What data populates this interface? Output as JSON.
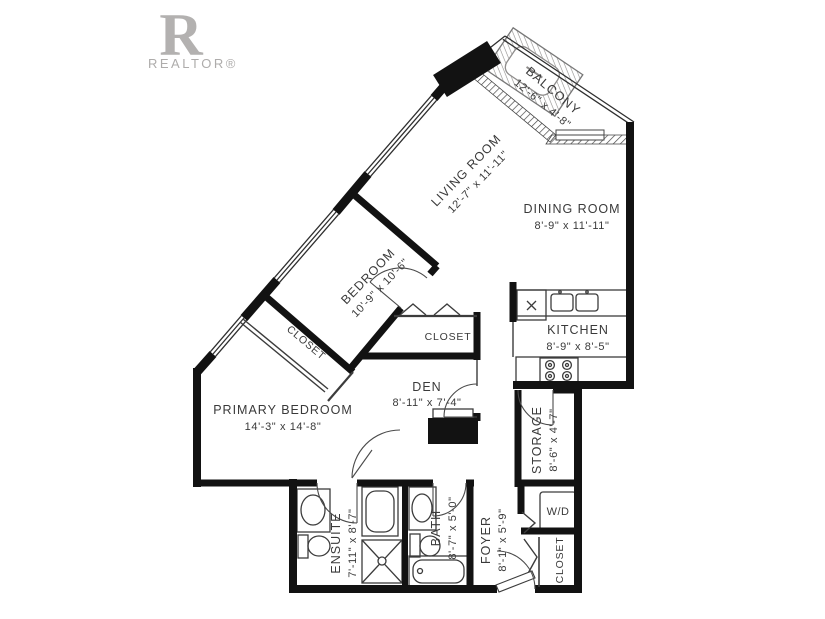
{
  "logo": {
    "monogram": "R",
    "wordmark": "REALTOR®"
  },
  "rooms": [
    {
      "id": "balcony",
      "name": "BALCONY",
      "dims": "12'-6\" x 4'-8\""
    },
    {
      "id": "living-room",
      "name": "LIVING ROOM",
      "dims": "12'-7\" x 11'-11\""
    },
    {
      "id": "dining-room",
      "name": "DINING ROOM",
      "dims": "8'-9\" x 11'-11\""
    },
    {
      "id": "bedroom",
      "name": "BEDROOM",
      "dims": "10'-9\" x 10'-6\""
    },
    {
      "id": "kitchen",
      "name": "KITCHEN",
      "dims": "8'-9\" x 8'-5\""
    },
    {
      "id": "den",
      "name": "DEN",
      "dims": "8'-11\" x 7'-4\""
    },
    {
      "id": "primary-bedroom",
      "name": "PRIMARY BEDROOM",
      "dims": "14'-3\" x 14'-8\""
    },
    {
      "id": "storage",
      "name": "STORAGE",
      "dims": "8'-6\" x 4'-7\""
    },
    {
      "id": "ensuite",
      "name": "ENSUITE",
      "dims": "7'-11\" x 8'-7\""
    },
    {
      "id": "bath",
      "name": "BATH",
      "dims": "8'-7\" x 5'-0\""
    },
    {
      "id": "foyer",
      "name": "FOYER",
      "dims": "8'-1\" x 5'-9\""
    }
  ],
  "closets": {
    "bedroom_closet": "CLOSET",
    "den_closet": "CLOSET",
    "foyer_closet": "CLOSET"
  },
  "appliances": {
    "washer_dryer": "W/D"
  },
  "colors": {
    "wall": "#121212",
    "line": "#3c3c3c",
    "text": "#3a3a3a",
    "logo": "#b3b1b0"
  }
}
